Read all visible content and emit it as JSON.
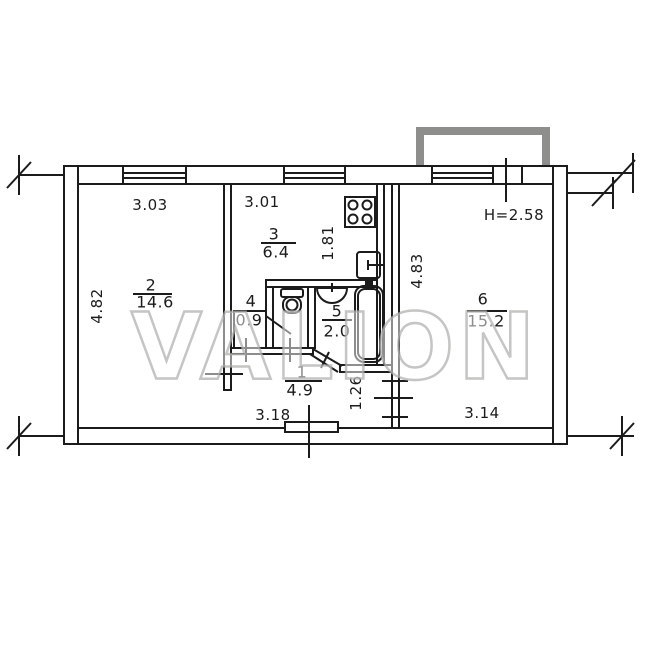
{
  "title": "apartment-floor-plan",
  "watermark": "VALION",
  "ceiling_height": "H=2.58",
  "rooms": [
    {
      "number": "1",
      "area": "4.9"
    },
    {
      "number": "2",
      "area": "14.6"
    },
    {
      "number": "3",
      "area": "6.4"
    },
    {
      "number": "4",
      "area": "0.9"
    },
    {
      "number": "5",
      "area": "2.0"
    },
    {
      "number": "6",
      "area": "15.2"
    }
  ],
  "dimensions": {
    "room2_width": "3.03",
    "kitchen_width": "3.01",
    "kitchen_inner_depth": "1.81",
    "room2_depth": "4.82",
    "room6_depth": "4.83",
    "hall_width": "3.18",
    "room6_width": "3.14",
    "nook_depth": "1.26"
  },
  "fixtures": [
    "stove",
    "kitchen-sink",
    "toilet",
    "wash-basin",
    "bathtub"
  ],
  "colors": {
    "line": "#1b1b1b",
    "balcony_stroke": "#8e8e8c",
    "watermark": "#adadaa",
    "background": "#ffffff"
  }
}
